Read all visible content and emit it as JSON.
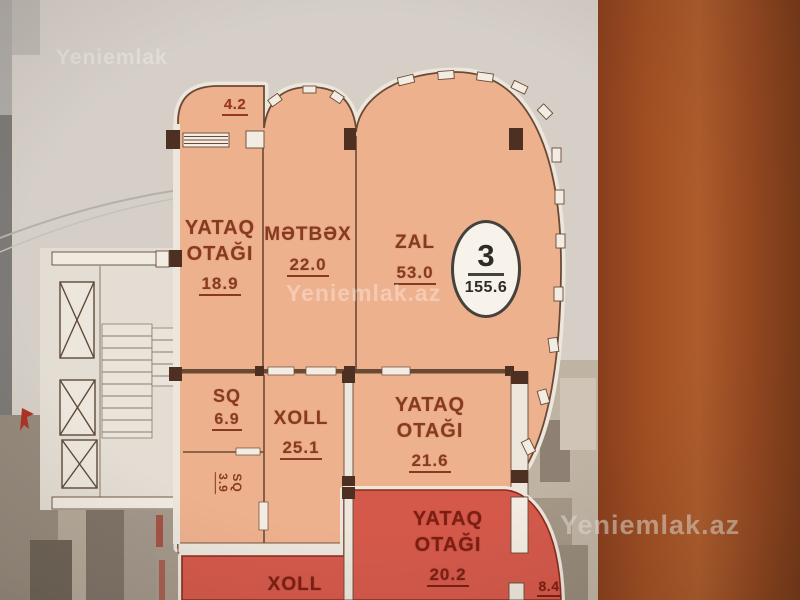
{
  "watermarks": {
    "top_left": "Yeniemlak",
    "center": "Yeniemlak.az",
    "bottom_right": "Yeniemlak.az"
  },
  "plan": {
    "badge": {
      "apartment_number": "3",
      "total_area": "155.6"
    },
    "balcony_dimension": "4.2",
    "rooms": [
      {
        "name": "YATAQ OTAĞI",
        "area": "18.9"
      },
      {
        "name": "MƏTBƏX",
        "area": "22.0"
      },
      {
        "name": "ZAL",
        "area": "53.0"
      },
      {
        "name": "SQ",
        "area": "6.9"
      },
      {
        "name": "SQ",
        "area": "3.9"
      },
      {
        "name": "XOLL",
        "area": "25.1"
      },
      {
        "name": "YATAQ OTAĞI",
        "area": "21.6"
      }
    ],
    "neighbor_rooms": [
      {
        "name": "YATAQ OTAĞI",
        "area": "20.2"
      },
      {
        "name": "XOLL"
      },
      {
        "area": "8.4"
      }
    ]
  },
  "colors": {
    "room_fill": "#f0b18d",
    "neighbor_fill": "#d8584a",
    "wall": "#6b4a33",
    "side_panel": "#9a4a20",
    "label": "#8a3a1f",
    "label_red": "#7e1d10"
  }
}
